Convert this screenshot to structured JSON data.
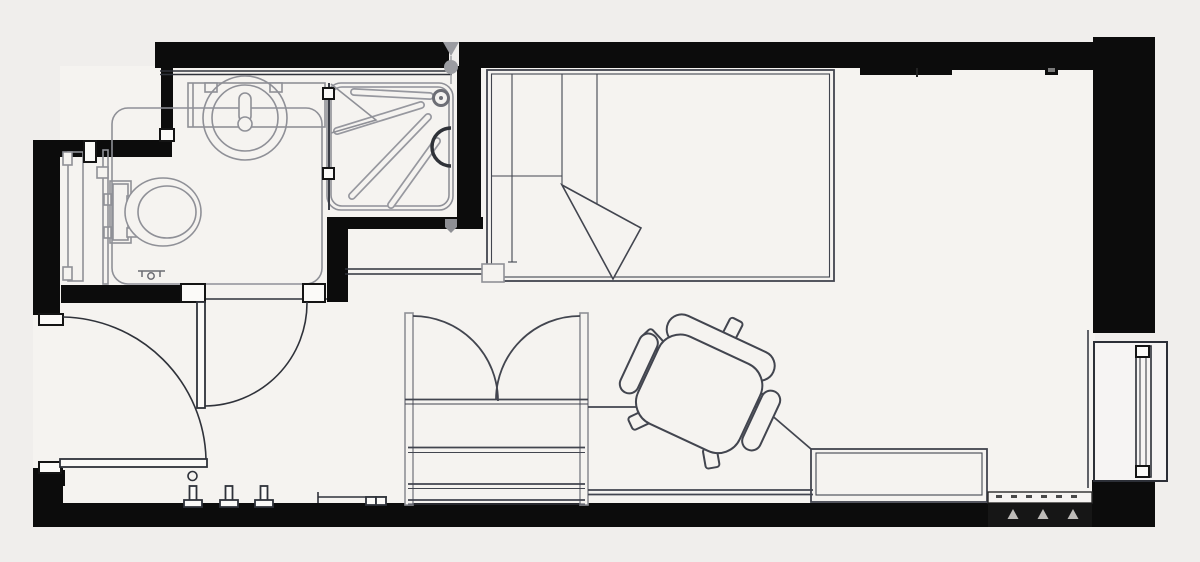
{
  "meta": {
    "title": "Studio apartment floor plan",
    "description": "Black-and-white architectural plan of a studio room with en-suite bathroom; drawing contains no text labels"
  },
  "colors": {
    "bg": "#f0eeec",
    "room": "#f5f3f0",
    "wall": "#0c0c0c",
    "ink": "#2f323a",
    "furniture": "#42454f",
    "fixture": "#8f9097",
    "light_line": "#6e717b",
    "marker": "#9b9ca1",
    "strip_dark": "#161616",
    "strip_triangle": "#bdbbb8",
    "leaf_fill": "#fbfaf8"
  },
  "inventory": {
    "rooms": [
      "bathroom",
      "bed-area",
      "study-area",
      "entry"
    ],
    "bathroom_fixtures": [
      "toilet",
      "wash-basin",
      "vanity-counter",
      "shower-tray",
      "shower-drain",
      "shower-screen",
      "grab-rail-panel",
      "floor-outline",
      "floor-drain"
    ],
    "furniture": [
      "single-bed",
      "turned-down-sheet",
      "wardrobe",
      "desk",
      "desk-return-unit",
      "office-chair",
      "wall-bench"
    ],
    "openings": [
      "entry-door",
      "bathroom-door",
      "window",
      "radiator"
    ],
    "details": [
      "coat-hooks",
      "door-stop",
      "survey-marker",
      "hatched-wall-strip"
    ]
  }
}
